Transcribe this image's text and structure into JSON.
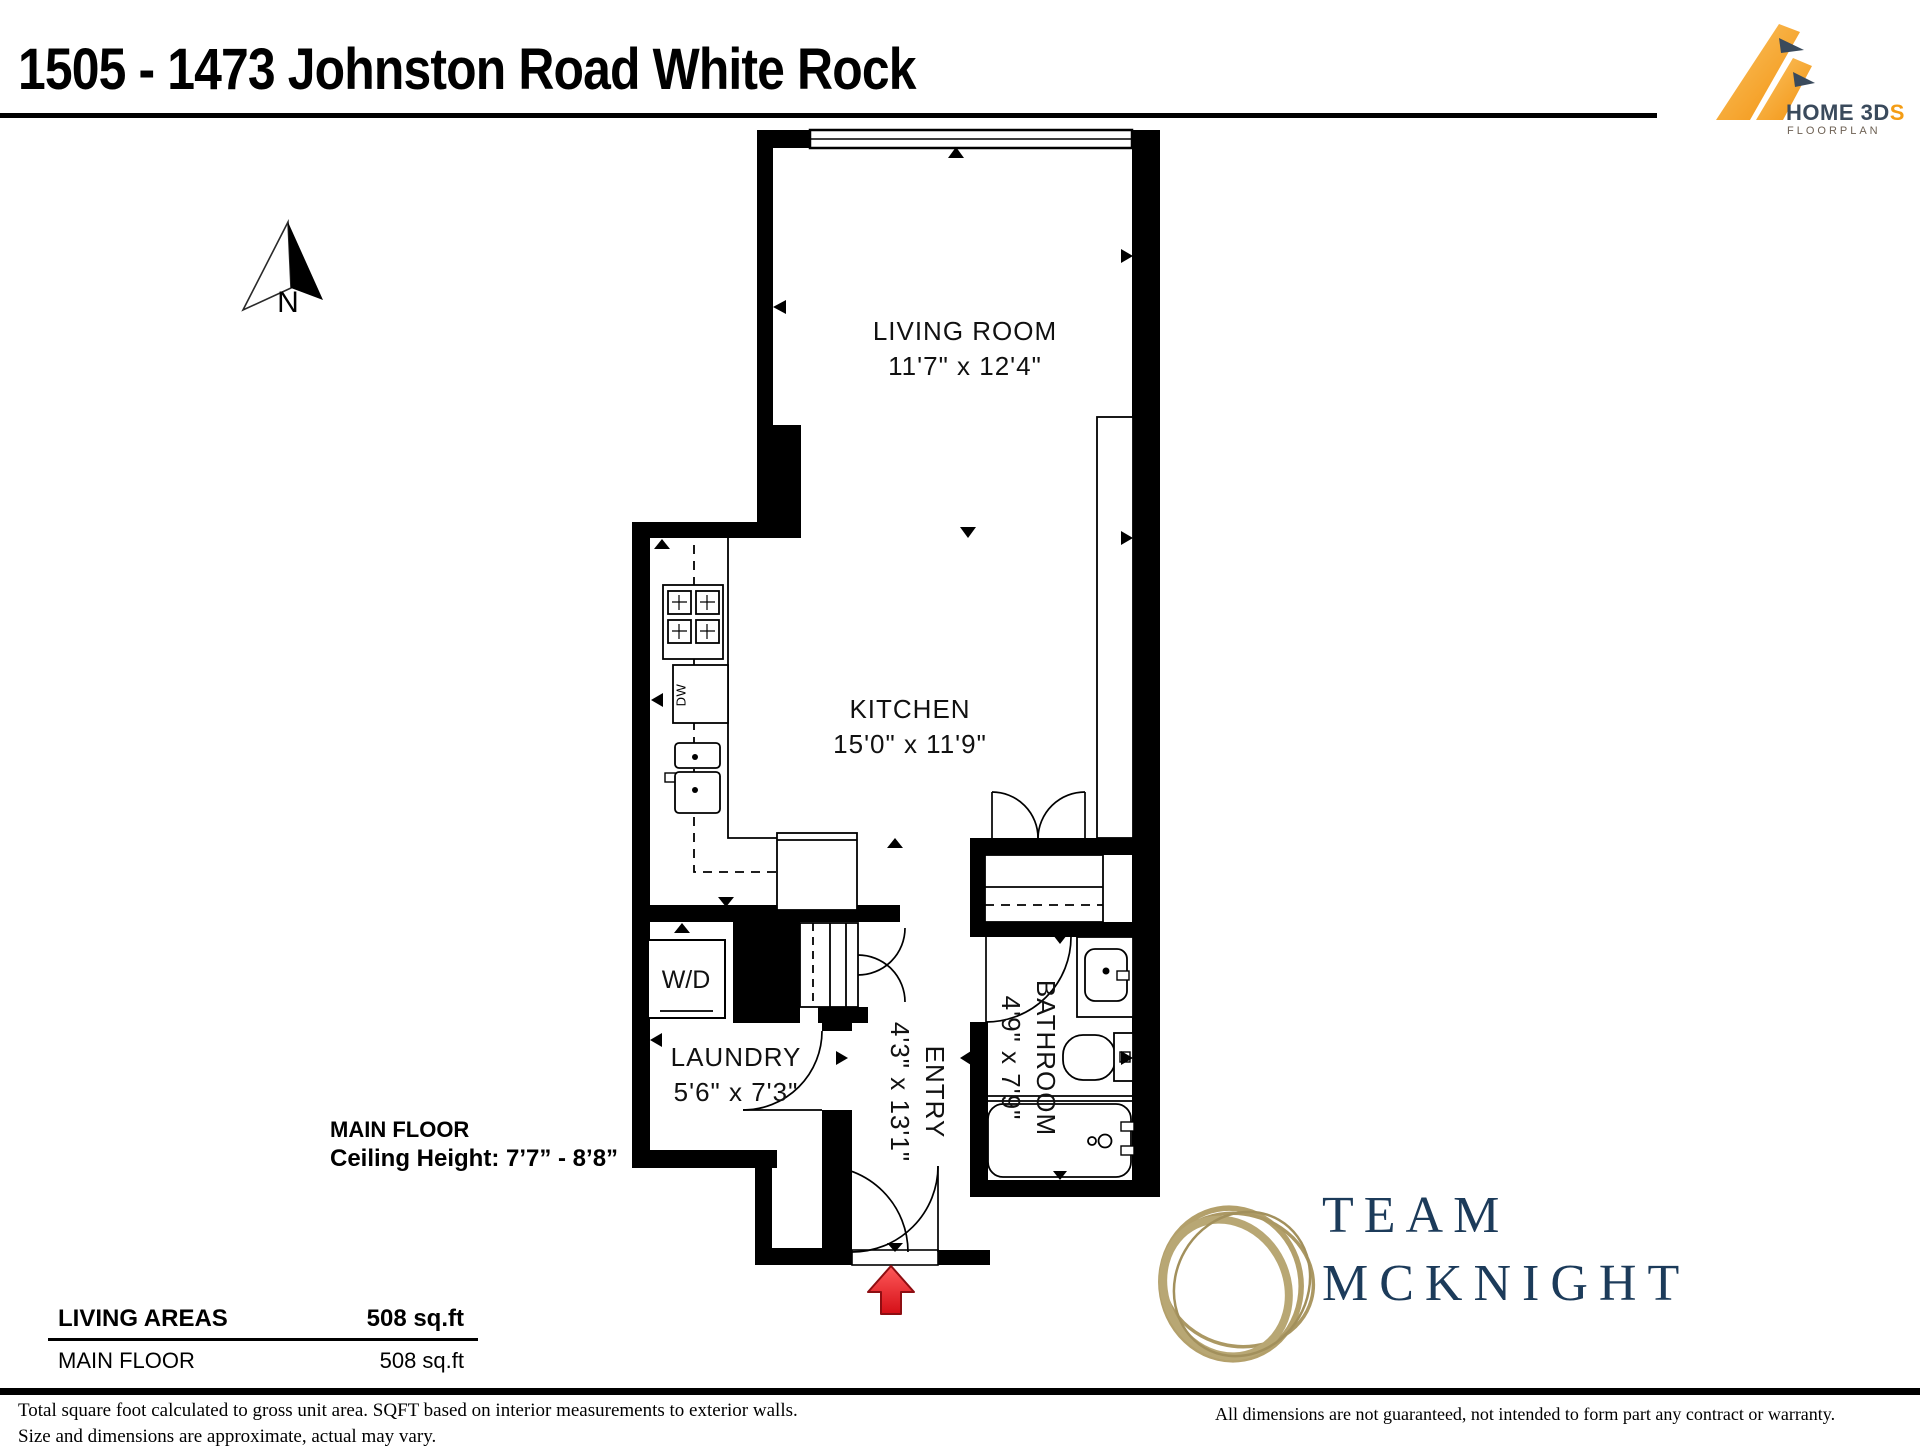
{
  "title": "1505 - 1473 Johnston Road White Rock",
  "logo": {
    "name": "HOME 3D",
    "accent": "S",
    "tagline": "FLOORPLAN"
  },
  "compass": {
    "label": "N"
  },
  "rooms": {
    "living": {
      "name": "LIVING ROOM",
      "dims": "11'7\" x 12'4\""
    },
    "kitchen": {
      "name": "KITCHEN",
      "dims": "15'0\" x 11'9\""
    },
    "laundry": {
      "name": "LAUNDRY",
      "dims": "5'6\" x 7'3\""
    },
    "entry": {
      "name": "ENTRY",
      "dims": "4'3\" x 13'1\""
    },
    "bathroom": {
      "name": "BATHROOM",
      "dims": "4'9\" x 7'9\""
    }
  },
  "fixtures": {
    "washer_dryer": "W/D",
    "dishwasher": "DW"
  },
  "floor_info": {
    "name": "MAIN FLOOR",
    "ceiling": "Ceiling Height: 7’7” - 8’8”"
  },
  "areas": {
    "header": "LIVING AREAS",
    "header_value": "508 sq.ft",
    "rows": [
      {
        "label": "MAIN FLOOR",
        "value": "508 sq.ft"
      }
    ]
  },
  "footer": {
    "left_line1": "Total square foot calculated to gross unit area. SQFT based on interior measurements to exterior walls.",
    "left_line2": "Size and dimensions are approximate, actual may vary.",
    "right": "All dimensions are not guaranteed, not intended to form part any contract or warranty."
  },
  "brand": {
    "line1": "TEAM",
    "line2": "MCKNIGHT"
  },
  "colors": {
    "accent_orange": "#f5a01e",
    "brand_navy": "#1c3b5a",
    "brand_gold": "#b3a06b",
    "entry_arrow_red": "#e01b22"
  }
}
